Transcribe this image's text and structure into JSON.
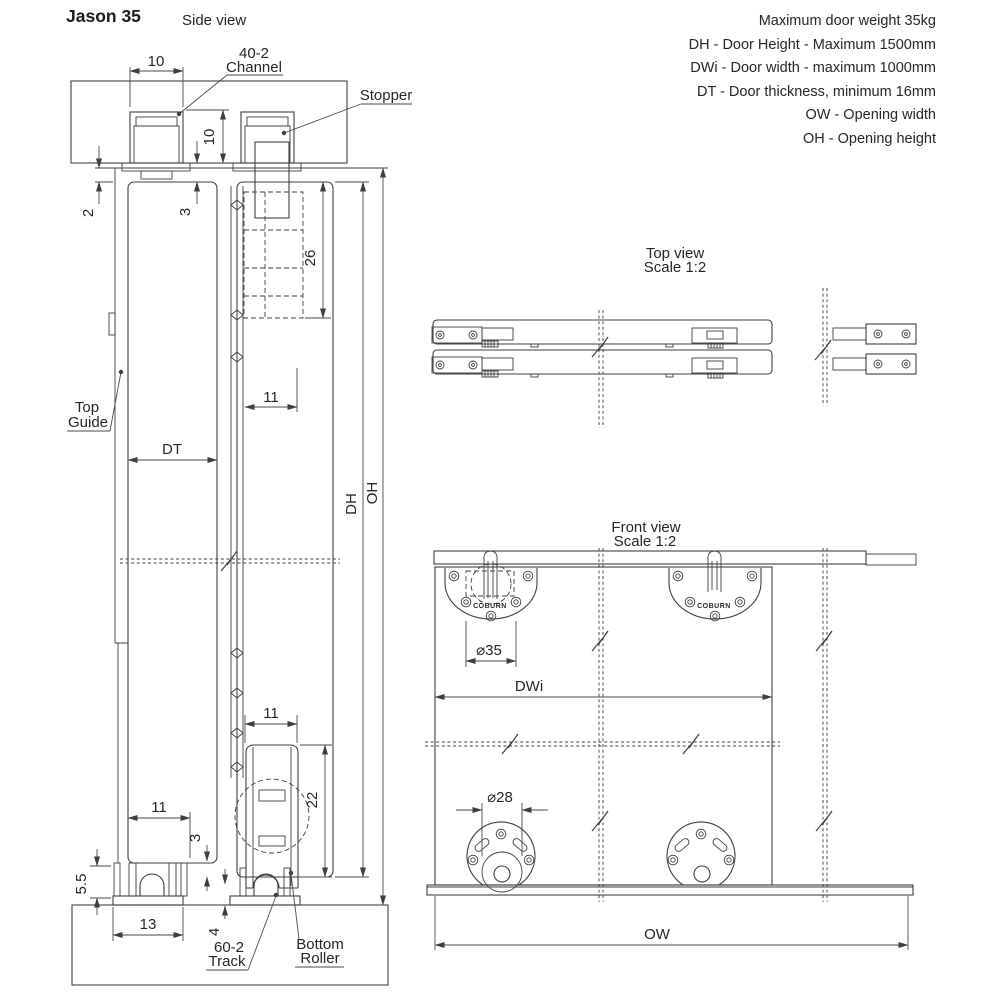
{
  "title": "Jason 35",
  "specs": [
    "Maximum door weight 35kg",
    "DH - Door Height - Maximum 1500mm",
    "DWi - Door width - maximum 1000mm",
    "DT - Door thickness, minimum 16mm",
    "OW - Opening width",
    "OH - Opening height"
  ],
  "views": {
    "side": {
      "title": "Side view"
    },
    "top": {
      "title": "Top view",
      "scale": "Scale 1:2"
    },
    "front": {
      "title": "Front view",
      "scale": "Scale 1:2"
    }
  },
  "callouts": {
    "channel": [
      "40-2",
      "Channel"
    ],
    "stopper": "Stopper",
    "top_guide": [
      "Top",
      "Guide"
    ],
    "track": [
      "60-2",
      "Track"
    ],
    "bottom_roller": [
      "Bottom",
      "Roller"
    ]
  },
  "dims": {
    "side": {
      "channel_width": "10",
      "channel_height": "10",
      "top_gap": "2",
      "top_clearance": "3",
      "stopper_drop": "26",
      "hanger_inset": "11",
      "door_thickness": "DT",
      "door_height": "DH",
      "opening_height": "OH",
      "roller_inset": "11",
      "roller_height": "22",
      "track_inset": "11",
      "bottom_clearance": "3",
      "engagement": "5.5",
      "track_width": "13",
      "track_lift": "4"
    },
    "front": {
      "hanger_dia": "⌀35",
      "door_width": "DWi",
      "roller_dia": "⌀28",
      "opening_width": "OW"
    }
  },
  "brand": "COBURN",
  "colors": {
    "line": "#3f3f3f",
    "text": "#262626",
    "background": "#ffffff"
  }
}
